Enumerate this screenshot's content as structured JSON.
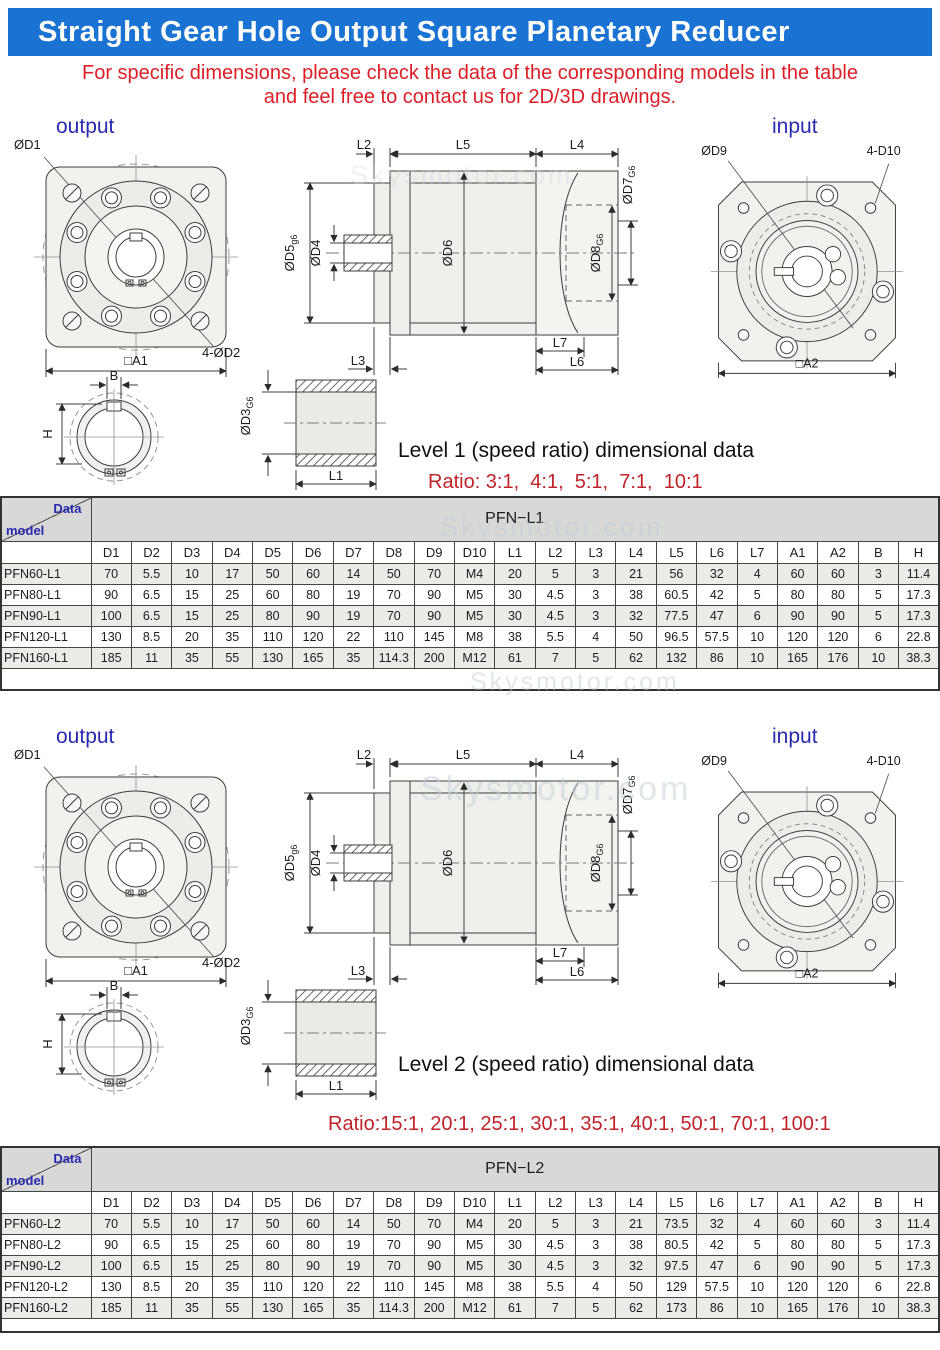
{
  "colors": {
    "banner_blue": "#1a72d2",
    "notice_red": "#dc1e26",
    "ratio_red": "#c0232a",
    "label_blue": "#2a2ab0",
    "table_gray": "#d8d8d6",
    "row_gray": "#ebebe8"
  },
  "header": {
    "title": "Straight Gear Hole Output Square Planetary Reducer"
  },
  "notice": {
    "line1": "For specific dimensions, please check the data of the corresponding models in the table",
    "line2": "and feel free to contact us for 2D/3D drawings."
  },
  "watermark": "Skysmotor.com",
  "drawing": {
    "output_label": "output",
    "input_label": "input",
    "labels": {
      "od1": "ØD1",
      "od2": "4-ØD2",
      "a1": "□A1",
      "od9": "ØD9",
      "d10": "4-D10",
      "a2": "□A2",
      "l2": "L2",
      "l5": "L5",
      "l4": "L4",
      "l3": "L3",
      "l6": "L6",
      "l7": "L7",
      "l1": "L1",
      "od4": "ØD4",
      "od6": "ØD6",
      "od5": {
        "main": "ØD5",
        "sub": "g6"
      },
      "od7": {
        "main": "ØD7",
        "sub": "G6"
      },
      "od8": {
        "main": "ØD8",
        "sub": "G6"
      },
      "od3": {
        "main": "ØD3",
        "sub": "G6"
      },
      "b": "B",
      "h": "H"
    }
  },
  "sections": [
    {
      "heading": "Level 1 (speed ratio) dimensional data",
      "ratio": "Ratio: 3:1,  4:1,  5:1,  7:1,  10:1",
      "table": {
        "corner_top": "Data",
        "corner_bottom": "model",
        "group_header": "PFN−L1",
        "columns": [
          "D1",
          "D2",
          "D3",
          "D4",
          "D5",
          "D6",
          "D7",
          "D8",
          "D9",
          "D10",
          "L1",
          "L2",
          "L3",
          "L4",
          "L5",
          "L6",
          "L7",
          "A1",
          "A2",
          "B",
          "H"
        ],
        "rows": [
          {
            "model": "PFN60-L1",
            "values": [
              "70",
              "5.5",
              "10",
              "17",
              "50",
              "60",
              "14",
              "50",
              "70",
              "M4",
              "20",
              "5",
              "3",
              "21",
              "56",
              "32",
              "4",
              "60",
              "60",
              "3",
              "11.4"
            ]
          },
          {
            "model": "PFN80-L1",
            "values": [
              "90",
              "6.5",
              "15",
              "25",
              "60",
              "80",
              "19",
              "70",
              "90",
              "M5",
              "30",
              "4.5",
              "3",
              "38",
              "60.5",
              "42",
              "5",
              "80",
              "80",
              "5",
              "17.3"
            ]
          },
          {
            "model": "PFN90-L1",
            "values": [
              "100",
              "6.5",
              "15",
              "25",
              "80",
              "90",
              "19",
              "70",
              "90",
              "M5",
              "30",
              "4.5",
              "3",
              "32",
              "77.5",
              "47",
              "6",
              "90",
              "90",
              "5",
              "17.3"
            ]
          },
          {
            "model": "PFN120-L1",
            "values": [
              "130",
              "8.5",
              "20",
              "35",
              "110",
              "120",
              "22",
              "110",
              "145",
              "M8",
              "38",
              "5.5",
              "4",
              "50",
              "96.5",
              "57.5",
              "10",
              "120",
              "120",
              "6",
              "22.8"
            ]
          },
          {
            "model": "PFN160-L1",
            "values": [
              "185",
              "11",
              "35",
              "55",
              "130",
              "165",
              "35",
              "114.3",
              "200",
              "M12",
              "61",
              "7",
              "5",
              "62",
              "132",
              "86",
              "10",
              "165",
              "176",
              "10",
              "38.3"
            ]
          }
        ]
      }
    },
    {
      "heading": "Level 2 (speed ratio) dimensional data",
      "ratio": "Ratio:15:1, 20:1, 25:1, 30:1, 35:1, 40:1, 50:1, 70:1, 100:1",
      "table": {
        "corner_top": "Data",
        "corner_bottom": "model",
        "group_header": "PFN−L2",
        "columns": [
          "D1",
          "D2",
          "D3",
          "D4",
          "D5",
          "D6",
          "D7",
          "D8",
          "D9",
          "D10",
          "L1",
          "L2",
          "L3",
          "L4",
          "L5",
          "L6",
          "L7",
          "A1",
          "A2",
          "B",
          "H"
        ],
        "rows": [
          {
            "model": "PFN60-L2",
            "values": [
              "70",
              "5.5",
              "10",
              "17",
              "50",
              "60",
              "14",
              "50",
              "70",
              "M4",
              "20",
              "5",
              "3",
              "21",
              "73.5",
              "32",
              "4",
              "60",
              "60",
              "3",
              "11.4"
            ]
          },
          {
            "model": "PFN80-L2",
            "values": [
              "90",
              "6.5",
              "15",
              "25",
              "60",
              "80",
              "19",
              "70",
              "90",
              "M5",
              "30",
              "4.5",
              "3",
              "38",
              "80.5",
              "42",
              "5",
              "80",
              "80",
              "5",
              "17.3"
            ]
          },
          {
            "model": "PFN90-L2",
            "values": [
              "100",
              "6.5",
              "15",
              "25",
              "80",
              "90",
              "19",
              "70",
              "90",
              "M5",
              "30",
              "4.5",
              "3",
              "32",
              "97.5",
              "47",
              "6",
              "90",
              "90",
              "5",
              "17.3"
            ]
          },
          {
            "model": "PFN120-L2",
            "values": [
              "130",
              "8.5",
              "20",
              "35",
              "110",
              "120",
              "22",
              "110",
              "145",
              "M8",
              "38",
              "5.5",
              "4",
              "50",
              "129",
              "57.5",
              "10",
              "120",
              "120",
              "6",
              "22.8"
            ]
          },
          {
            "model": "PFN160-L2",
            "values": [
              "185",
              "11",
              "35",
              "55",
              "130",
              "165",
              "35",
              "114.3",
              "200",
              "M12",
              "61",
              "7",
              "5",
              "62",
              "173",
              "86",
              "10",
              "165",
              "176",
              "10",
              "38.3"
            ]
          }
        ]
      }
    }
  ]
}
